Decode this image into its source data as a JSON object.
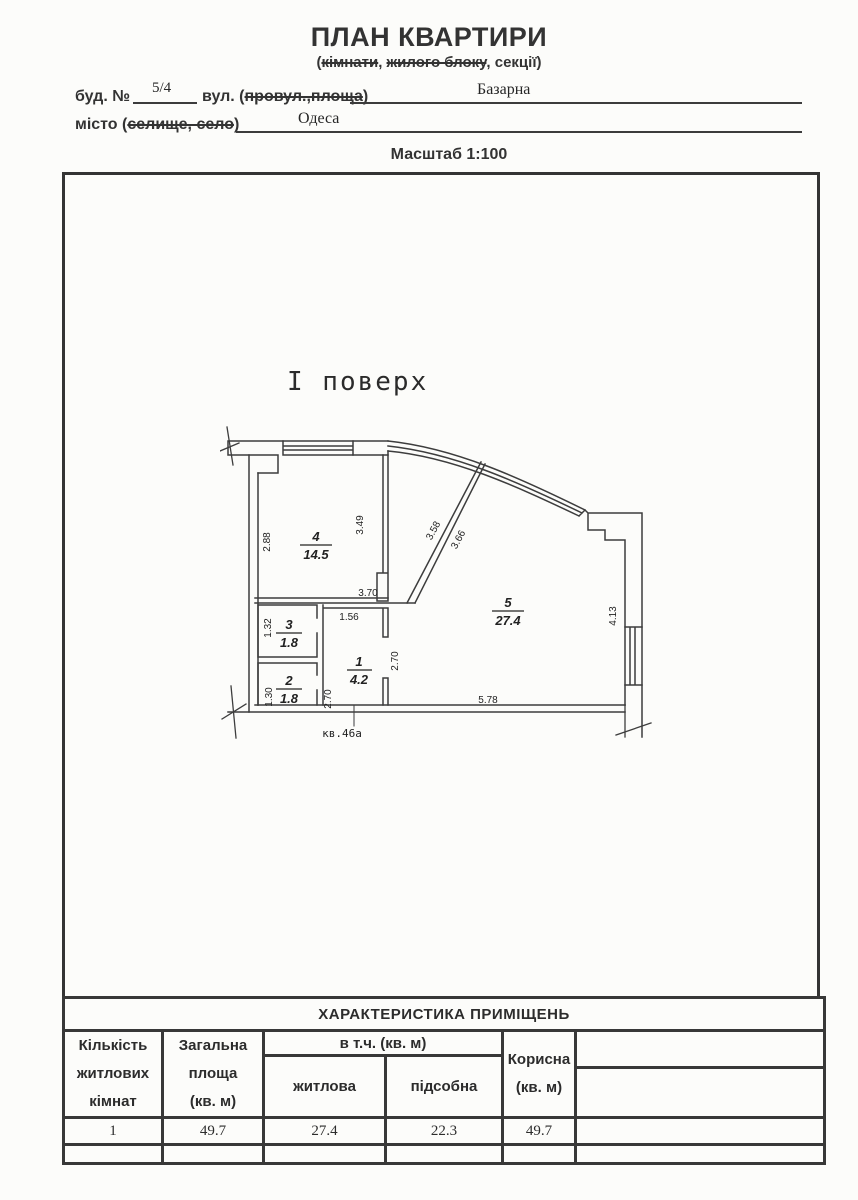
{
  "page": {
    "title": "ПЛАН КВАРТИРИ",
    "subtitle": {
      "open": "(",
      "struck_a": "кімнати",
      "comma_a": ", ",
      "struck_b": "жилого блоку",
      "comma_b": ", ",
      "plain": "секції",
      "close": ")"
    },
    "form": {
      "building_label": "буд. №",
      "building_value": "5/4",
      "street_label_open": "вул. (",
      "street_label_struck": "провул.,площа",
      "street_label_close": ")",
      "street_value": "Базарна",
      "city_label_open": "місто (",
      "city_label_struck": "селище, село",
      "city_label_close": ")",
      "city_value": "Одеса"
    },
    "scale_label": "Масштаб 1:100"
  },
  "plan": {
    "floor_label": "І поверх",
    "apartment_label": "кв.46а",
    "rooms": [
      {
        "num": "4",
        "area": "14.5"
      },
      {
        "num": "3",
        "area": "1.8"
      },
      {
        "num": "2",
        "area": "1.8"
      },
      {
        "num": "1",
        "area": "4.2"
      },
      {
        "num": "5",
        "area": "27.4"
      }
    ],
    "dims": {
      "left_wall": "2.88",
      "room4_right": "3.49",
      "room4_width": "3.70",
      "diag_outer": "3.58",
      "diag_inner": "3.66",
      "room3_height": "1.32",
      "room2_height": "1.30",
      "room1_width": "1.56",
      "room1_height": "2.70",
      "room5_left": "2.70",
      "room5_bottom": "5.78",
      "room5_right": "4.13"
    }
  },
  "table": {
    "title": "ХАРАКТЕРИСТИКА ПРИМІЩЕНЬ",
    "col_rooms_lines": [
      "Кількість",
      "житлових",
      "кімнат"
    ],
    "col_total_lines": [
      "Загальна",
      "площа",
      "(кв. м)"
    ],
    "group_header": "в т.ч. (кв. м)",
    "sub_living": "житлова",
    "sub_utility": "підсобна",
    "col_useful_lines": [
      "Корисна",
      "(кв. м)"
    ],
    "data_row": {
      "rooms": "1",
      "total": "49.7",
      "living": "27.4",
      "utility": "22.3",
      "useful": "49.7"
    }
  }
}
